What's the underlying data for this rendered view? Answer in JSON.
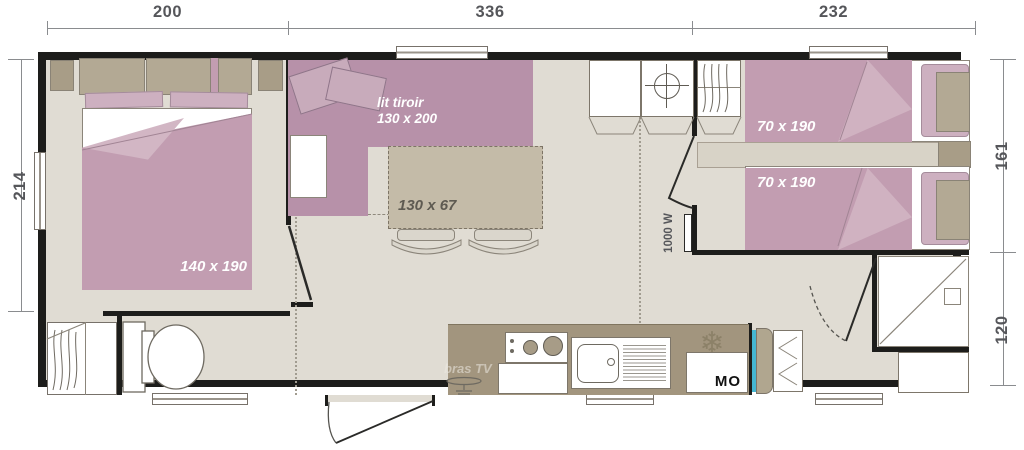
{
  "plan": {
    "dimensions": {
      "top": [
        "200",
        "336",
        "232"
      ],
      "left": [
        "214"
      ],
      "right": [
        "161",
        "120"
      ]
    },
    "labels": {
      "sofa_bed_name": "lit tiroir",
      "sofa_bed_size": "130 x 200",
      "table_size": "130 x 67",
      "master_bed_size": "140 x 190",
      "twin_bed_top_size": "70 x 190",
      "twin_bed_bottom_size": "70 x 190",
      "radiator_power": "1000 W",
      "tv_bracket": "bras TV",
      "microwave": "MO"
    },
    "icons": {
      "fridge_snowflake": "❄"
    },
    "colors": {
      "wall": "#1d1d1b",
      "floor": "#e0dcd3",
      "bed_pink": "#c29db1",
      "bed_pink_light": "#d2b6c4",
      "sofa_pink": "#b791a9",
      "pillow_pink": "#cdb0c0",
      "furniture_taupe": "#b3a994",
      "counter_taupe": "#a2957e",
      "table_taupe": "#c4bba8",
      "shelf_beige": "#d8d3c7",
      "accent_blue": "#44b6d2",
      "dimension_gray": "#58595b"
    }
  }
}
